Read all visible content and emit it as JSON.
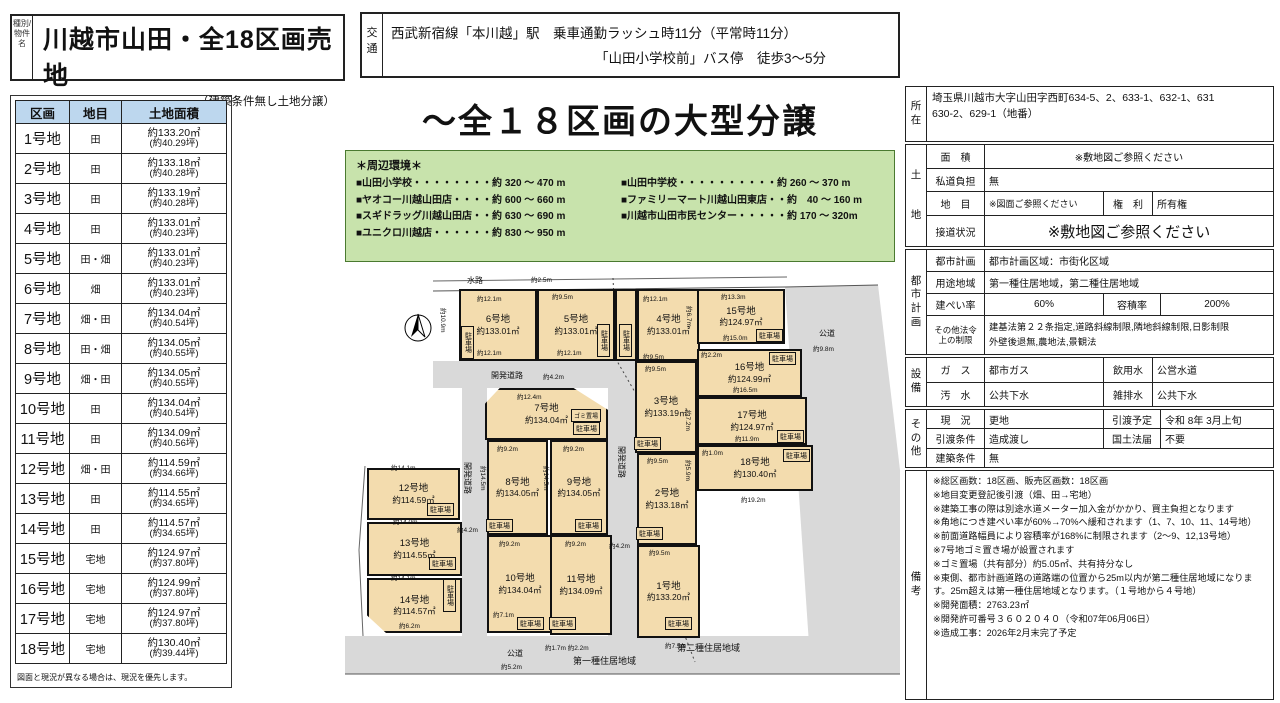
{
  "header": {
    "category": "種別/物件名",
    "title": "川越市山田・全18区画売地",
    "subtitle": "（建築条件無し土地分譲）"
  },
  "transport": {
    "label": "交通",
    "line1": "西武新宿線「本川越」駅　乗車通勤ラッシュ時11分（平常時11分）",
    "line2": "「山田小学校前」バス停　徒歩3～5分"
  },
  "parcel_table": {
    "headers": [
      "区画",
      "地目",
      "土地面積"
    ],
    "rows": [
      {
        "no": "1号地",
        "type": "田",
        "area": "約133.20㎡",
        "tsubo": "(約40.29坪)"
      },
      {
        "no": "2号地",
        "type": "田",
        "area": "約133.18㎡",
        "tsubo": "(約40.28坪)"
      },
      {
        "no": "3号地",
        "type": "田",
        "area": "約133.19㎡",
        "tsubo": "(約40.28坪)"
      },
      {
        "no": "4号地",
        "type": "田",
        "area": "約133.01㎡",
        "tsubo": "(約40.23坪)"
      },
      {
        "no": "5号地",
        "type": "田・畑",
        "area": "約133.01㎡",
        "tsubo": "(約40.23坪)"
      },
      {
        "no": "6号地",
        "type": "畑",
        "area": "約133.01㎡",
        "tsubo": "(約40.23坪)"
      },
      {
        "no": "7号地",
        "type": "畑・田",
        "area": "約134.04㎡",
        "tsubo": "(約40.54坪)"
      },
      {
        "no": "8号地",
        "type": "田・畑",
        "area": "約134.05㎡",
        "tsubo": "(約40.55坪)"
      },
      {
        "no": "9号地",
        "type": "畑・田",
        "area": "約134.05㎡",
        "tsubo": "(約40.55坪)"
      },
      {
        "no": "10号地",
        "type": "田",
        "area": "約134.04㎡",
        "tsubo": "(約40.54坪)"
      },
      {
        "no": "11号地",
        "type": "田",
        "area": "約134.09㎡",
        "tsubo": "(約40.56坪)"
      },
      {
        "no": "12号地",
        "type": "畑・田",
        "area": "約114.59㎡",
        "tsubo": "(約34.66坪)"
      },
      {
        "no": "13号地",
        "type": "田",
        "area": "約114.55㎡",
        "tsubo": "(約34.65坪)"
      },
      {
        "no": "14号地",
        "type": "田",
        "area": "約114.57㎡",
        "tsubo": "(約34.65坪)"
      },
      {
        "no": "15号地",
        "type": "宅地",
        "area": "約124.97㎡",
        "tsubo": "(約37.80坪)"
      },
      {
        "no": "16号地",
        "type": "宅地",
        "area": "約124.99㎡",
        "tsubo": "(約37.80坪)"
      },
      {
        "no": "17号地",
        "type": "宅地",
        "area": "約124.97㎡",
        "tsubo": "(約37.80坪)"
      },
      {
        "no": "18号地",
        "type": "宅地",
        "area": "約130.40㎡",
        "tsubo": "(約39.44坪)"
      }
    ],
    "note": "図面と現況が異なる場合は、現況を優先します。"
  },
  "main_title": "～全１８区画の大型分譲",
  "environment": {
    "title": "＊周辺環境＊",
    "left": [
      "■山田小学校・・・・・・・・約 320 ～ 470 m",
      "■ヤオコー川越山田店・・・・約 600 ～ 660 m",
      "■スギドラッグ川越山田店・・約 630 ～ 690 m",
      "■ユニクロ川越店・・・・・・約 830 ～ 950 m"
    ],
    "right": [
      "■山田中学校・・・・・・・・・・約 260 ～ 370 m",
      "■ファミリーマート川越山田東店・・約　40 ～ 160 m",
      "■川越市山田市民センター・・・・・約 170 ～ 320m"
    ]
  },
  "map": {
    "parking_label": "駐車場",
    "gomi_label": "ゴミ置場",
    "parcels": [
      {
        "name": "6号地",
        "area": "約133.01㎡",
        "x": 114,
        "y": 19,
        "w": 78,
        "h": 72
      },
      {
        "name": "5号地",
        "area": "約133.01㎡",
        "x": 192,
        "y": 19,
        "w": 78,
        "h": 72
      },
      {
        "name": "",
        "area": "",
        "x": 270,
        "y": 19,
        "w": 22,
        "h": 72
      },
      {
        "name": "4号地",
        "area": "約133.01㎡",
        "x": 292,
        "y": 19,
        "w": 63,
        "h": 72
      },
      {
        "name": "15号地",
        "area": "約124.97㎡",
        "x": 352,
        "y": 19,
        "w": 88,
        "h": 55
      },
      {
        "name": "16号地",
        "area": "約124.99㎡",
        "x": 352,
        "y": 79,
        "w": 105,
        "h": 48
      },
      {
        "name": "17号地",
        "area": "約124.97㎡",
        "x": 352,
        "y": 127,
        "w": 110,
        "h": 48
      },
      {
        "name": "18号地",
        "area": "約130.40㎡",
        "x": 352,
        "y": 175,
        "w": 116,
        "h": 46
      },
      {
        "name": "7号地",
        "area": "約134.04㎡",
        "x": 140,
        "y": 118,
        "w": 123,
        "h": 52,
        "cls": "oct"
      },
      {
        "name": "3号地",
        "area": "約133.19㎡",
        "x": 290,
        "y": 91,
        "w": 62,
        "h": 92
      },
      {
        "name": "2号地",
        "area": "約133.18㎡",
        "x": 292,
        "y": 183,
        "w": 60,
        "h": 92
      },
      {
        "name": "1号地",
        "area": "約133.20㎡",
        "x": 292,
        "y": 275,
        "w": 63,
        "h": 93
      },
      {
        "name": "8号地",
        "area": "約134.05㎡",
        "x": 142,
        "y": 170,
        "w": 61,
        "h": 95
      },
      {
        "name": "9号地",
        "area": "約134.05㎡",
        "x": 205,
        "y": 170,
        "w": 58,
        "h": 95
      },
      {
        "name": "10号地",
        "area": "約134.04㎡",
        "x": 142,
        "y": 265,
        "w": 66,
        "h": 98
      },
      {
        "name": "11号地",
        "area": "約134.09㎡",
        "x": 205,
        "y": 265,
        "w": 62,
        "h": 100
      },
      {
        "name": "12号地",
        "area": "約114.59㎡",
        "x": 22,
        "y": 198,
        "w": 93,
        "h": 52
      },
      {
        "name": "13号地",
        "area": "約114.55㎡",
        "x": 22,
        "y": 252,
        "w": 95,
        "h": 54
      },
      {
        "name": "14号地",
        "area": "約114.57㎡",
        "x": 22,
        "y": 308,
        "w": 95,
        "h": 55,
        "cls": "cut"
      }
    ],
    "parking": [
      {
        "x": 116,
        "y": 56,
        "v": 1
      },
      {
        "x": 252,
        "y": 54,
        "v": 1
      },
      {
        "x": 274,
        "y": 54,
        "v": 1
      },
      {
        "x": 411,
        "y": 59
      },
      {
        "x": 424,
        "y": 82
      },
      {
        "x": 432,
        "y": 160
      },
      {
        "x": 438,
        "y": 179
      },
      {
        "x": 289,
        "y": 167
      },
      {
        "x": 291,
        "y": 257
      },
      {
        "x": 320,
        "y": 347
      },
      {
        "x": 228,
        "y": 152
      },
      {
        "x": 141,
        "y": 249
      },
      {
        "x": 230,
        "y": 249
      },
      {
        "x": 172,
        "y": 347
      },
      {
        "x": 204,
        "y": 347
      },
      {
        "x": 82,
        "y": 233
      },
      {
        "x": 84,
        "y": 287
      },
      {
        "x": 98,
        "y": 309,
        "v": 1
      }
    ],
    "dims": [
      {
        "t": "水路",
        "x": 122,
        "y": 5,
        "cls": "rd"
      },
      {
        "t": "約2.5m",
        "x": 186,
        "y": 4
      },
      {
        "t": "約12.1m",
        "x": 132,
        "y": 23
      },
      {
        "t": "約9.5m",
        "x": 207,
        "y": 21
      },
      {
        "t": "約12.1m",
        "x": 298,
        "y": 23
      },
      {
        "t": "約13.3m",
        "x": 376,
        "y": 21
      },
      {
        "t": "約10.9m",
        "x": 104,
        "y": 38,
        "rot": 1
      },
      {
        "t": "約6.7m",
        "x": 350,
        "y": 36,
        "rot": 1
      },
      {
        "t": "約12.1m",
        "x": 132,
        "y": 77
      },
      {
        "t": "約12.1m",
        "x": 212,
        "y": 77
      },
      {
        "t": "約9.5m",
        "x": 298,
        "y": 81
      },
      {
        "t": "約15.0m",
        "x": 378,
        "y": 62
      },
      {
        "t": "公道",
        "x": 474,
        "y": 58,
        "cls": "rd"
      },
      {
        "t": "約9.8m",
        "x": 468,
        "y": 73
      },
      {
        "t": "約2.2m",
        "x": 356,
        "y": 79
      },
      {
        "t": "約16.5m",
        "x": 388,
        "y": 114
      },
      {
        "t": "約7.2m",
        "x": 349,
        "y": 140,
        "rot": 1
      },
      {
        "t": "約11.9m",
        "x": 390,
        "y": 163
      },
      {
        "t": "約1.0m",
        "x": 357,
        "y": 177
      },
      {
        "t": "約5.9m",
        "x": 349,
        "y": 190,
        "rot": 1
      },
      {
        "t": "約19.2m",
        "x": 396,
        "y": 224
      },
      {
        "t": "開発道路",
        "x": 146,
        "y": 100,
        "cls": "rd"
      },
      {
        "t": "約4.2m",
        "x": 198,
        "y": 101
      },
      {
        "t": "約12.4m",
        "x": 172,
        "y": 121
      },
      {
        "t": "約9.5m",
        "x": 300,
        "y": 93
      },
      {
        "t": "約9.5m",
        "x": 302,
        "y": 185
      },
      {
        "t": "約9.5m",
        "x": 304,
        "y": 277
      },
      {
        "t": "約9.2m",
        "x": 152,
        "y": 173
      },
      {
        "t": "約9.2m",
        "x": 218,
        "y": 173
      },
      {
        "t": "約14.5m",
        "x": 144,
        "y": 196,
        "rot": 1
      },
      {
        "t": "約14.5m",
        "x": 207,
        "y": 196,
        "rot": 1
      },
      {
        "t": "約9.2m",
        "x": 154,
        "y": 268
      },
      {
        "t": "約9.2m",
        "x": 220,
        "y": 268
      },
      {
        "t": "約7.1m",
        "x": 148,
        "y": 339
      },
      {
        "t": "約14.1m",
        "x": 46,
        "y": 192
      },
      {
        "t": "約14.0m",
        "x": 48,
        "y": 246
      },
      {
        "t": "約14.1m",
        "x": 46,
        "y": 302
      },
      {
        "t": "約6.2m",
        "x": 54,
        "y": 350
      },
      {
        "t": "開発道路",
        "x": 128,
        "y": 192,
        "rot": 1,
        "cls": "rd"
      },
      {
        "t": "約4.2m",
        "x": 112,
        "y": 254
      },
      {
        "t": "開発道路",
        "x": 282,
        "y": 176,
        "rot": 1,
        "cls": "rd"
      },
      {
        "t": "約4.2m",
        "x": 264,
        "y": 270
      },
      {
        "t": "約1.7m 約2.2m",
        "x": 200,
        "y": 372
      },
      {
        "t": "約7.5m",
        "x": 320,
        "y": 370
      },
      {
        "t": "公道",
        "x": 162,
        "y": 378,
        "cls": "rd"
      },
      {
        "t": "約5.2m",
        "x": 156,
        "y": 391
      },
      {
        "t": "第一種住居地域",
        "x": 228,
        "y": 384,
        "cls": "zone"
      },
      {
        "t": "第二種住居地域",
        "x": 332,
        "y": 371,
        "cls": "zone"
      }
    ]
  },
  "right_panel": {
    "location": {
      "label": "所在",
      "line1": "埼玉県川越市大字山田字西町634-5、2、633-1、632-1、631",
      "line2": "630-2、629-1（地番）"
    },
    "land": {
      "label": "土地",
      "menseki_label": "面　積",
      "menseki": "※敷地図ご参照ください",
      "shido_label": "私道負担",
      "shido": "無",
      "chimoku_label": "地　目",
      "chimoku": "※図面ご参照ください",
      "kenri_label": "権　利",
      "kenri": "所有権",
      "setsudo_label": "接道状況",
      "setsudo": "※敷地図ご参照ください"
    },
    "city": {
      "label": "都市計画",
      "keikaku_label": "都市計画",
      "keikaku": "都市計画区域：市街化区域",
      "yoto_label": "用途地域",
      "yoto": "第一種住居地域，第二種住居地域",
      "kenpei_label": "建ぺい率",
      "kenpei": "60%",
      "yoseki_label": "容積率",
      "yoseki": "200%",
      "hoki_label1": "その他法令",
      "hoki_label2": "上の制限",
      "hoki1": "建基法第２２条指定,道路斜線制限,隣地斜線制限,日影制限",
      "hoki2": "外壁後退無,農地法,景観法"
    },
    "setsubi": {
      "label": "設備",
      "gas_label": "ガ　ス",
      "gas": "都市ガス",
      "inyo_label": "飲用水",
      "inyo": "公営水道",
      "osui_label": "汚　水",
      "osui": "公共下水",
      "zappai_label": "雑排水",
      "zappai": "公共下水"
    },
    "sonota": {
      "label": "その他",
      "genkyo_label": "現　況",
      "genkyo": "更地",
      "hikiwatashi_label": "引渡予定",
      "hikiwatashi": "令和 8年 3月上旬",
      "joken_label": "引渡条件",
      "joken": "造成渡し",
      "kokudo_label": "国土法届",
      "kokudo": "不要",
      "kenchiku_label": "建築条件",
      "kenchiku": "無"
    },
    "biko": {
      "label": "備考",
      "lines": [
        "※総区画数：18区画、販売区画数：18区画",
        "※地目変更登記後引渡（畑、田→宅地）",
        "※建築工事の際は別途水道メーター加入金がかかり、買主負担となります",
        "※角地につき建ぺい率が60%→70%へ緩和されます（1、7、10、11、14号地）",
        "※前面道路幅員により容積率が168%に制限されます（2～9、12,13号地）",
        "※7号地ゴミ置き場が設置されます",
        "※ゴミ置場（共有部分）約5.05㎡、共有持分なし",
        "※東側、都市計画道路の道路端の位置から25m以内が第二種住居地域になります。25m超えは第一種住居地域となります。（１号地から４号地）",
        "※開発面積：2763.23㎡",
        "※開発許可番号３６０２０４０（令和07年06月06日）",
        "※造成工事：2026年2月末完了予定"
      ]
    }
  }
}
